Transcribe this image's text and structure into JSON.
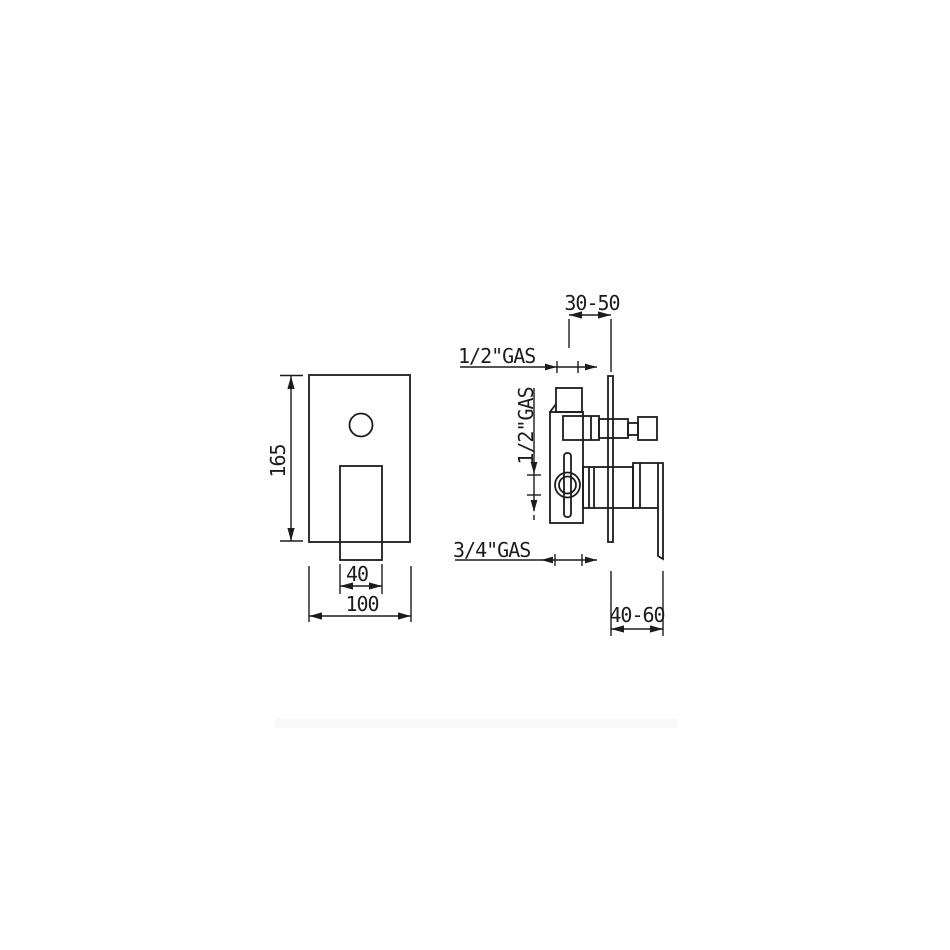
{
  "page": {
    "background": "#ffffff",
    "line_color": "#1c1c1c",
    "divider_color": "#f8f8f8"
  },
  "drawing": {
    "front_view": {
      "plate_height": "165",
      "handle_width": "40",
      "plate_width": "100"
    },
    "side_view": {
      "top_depth_range": "30-50",
      "bottom_depth_range": "40-60",
      "top_connection": "1/2\"GAS",
      "side_connection": "1/2\"GAS",
      "bottom_connection": "3/4\"GAS"
    }
  }
}
